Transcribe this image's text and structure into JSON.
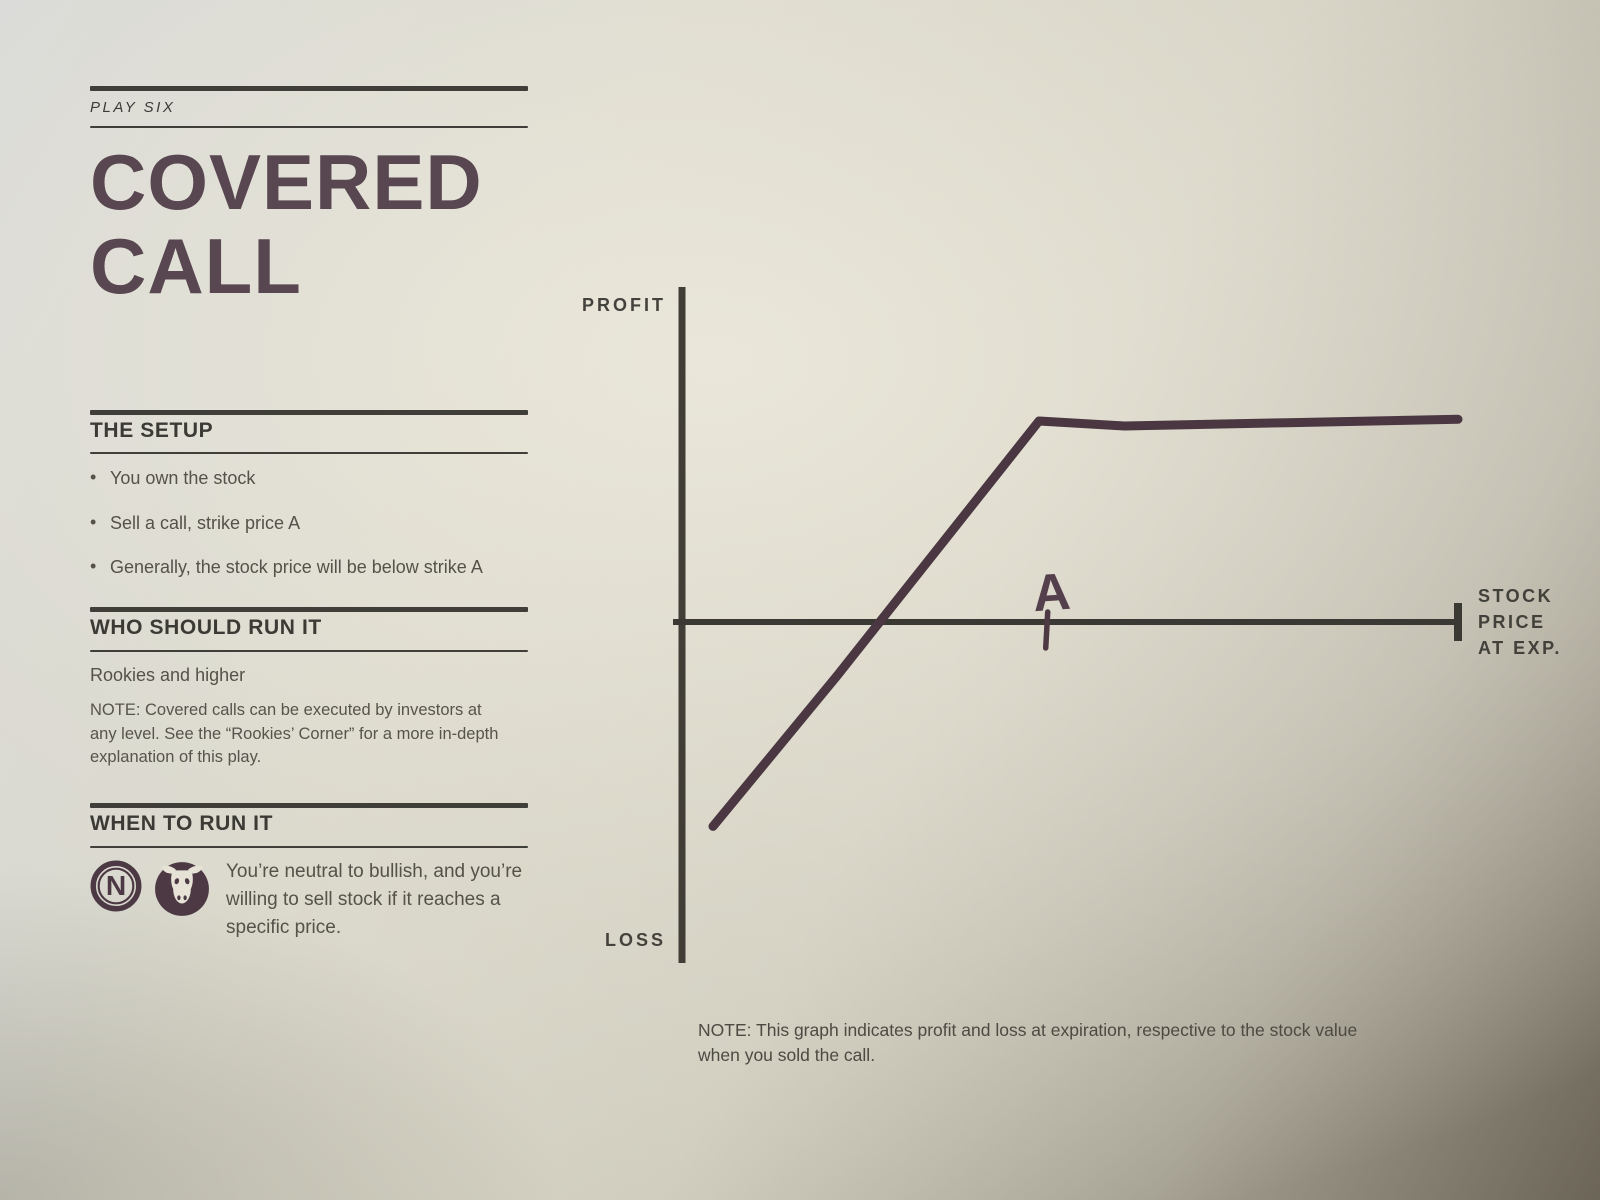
{
  "page": {
    "kicker": "PLAY SIX",
    "title_line1": "COVERED",
    "title_line2": "CALL"
  },
  "sections": {
    "setup": {
      "heading": "THE SETUP",
      "bullets": [
        "You own the stock",
        "Sell a call, strike price A",
        "Generally, the stock price will be below strike A"
      ]
    },
    "who": {
      "heading": "WHO SHOULD RUN IT",
      "level": "Rookies and higher",
      "note": "NOTE: Covered calls can be executed by investors at any level. See the “Rookies’ Corner” for a more in-depth explanation of this play."
    },
    "when": {
      "heading": "WHEN TO RUN IT",
      "icons": [
        {
          "name": "neutral-icon",
          "letter": "N"
        },
        {
          "name": "bull-icon"
        }
      ],
      "text": "You’re neutral to bullish, and you’re willing to sell stock if it reaches a specific price."
    }
  },
  "chart_data": {
    "type": "line",
    "title": "Covered call profit and loss at expiration",
    "ylabel_top": "PROFIT",
    "ylabel_bottom": "LOSS",
    "xlabel_lines": [
      "STOCK",
      "PRICE",
      "AT EXP."
    ],
    "x_range": [
      0,
      100
    ],
    "y_range": [
      -100,
      100
    ],
    "grid": false,
    "strike": {
      "label": "A",
      "x": 47
    },
    "series": [
      {
        "name": "profit-loss-at-expiration",
        "color": "#4a3741",
        "points": [
          [
            4,
            -61
          ],
          [
            20,
            -16
          ],
          [
            46,
            60
          ],
          [
            57,
            58.5
          ],
          [
            78,
            59.5
          ],
          [
            100,
            60.5
          ]
        ]
      }
    ]
  },
  "chart_note": "NOTE: This graph indicates profit and loss at expiration, respective to the stock value when you sold the call."
}
